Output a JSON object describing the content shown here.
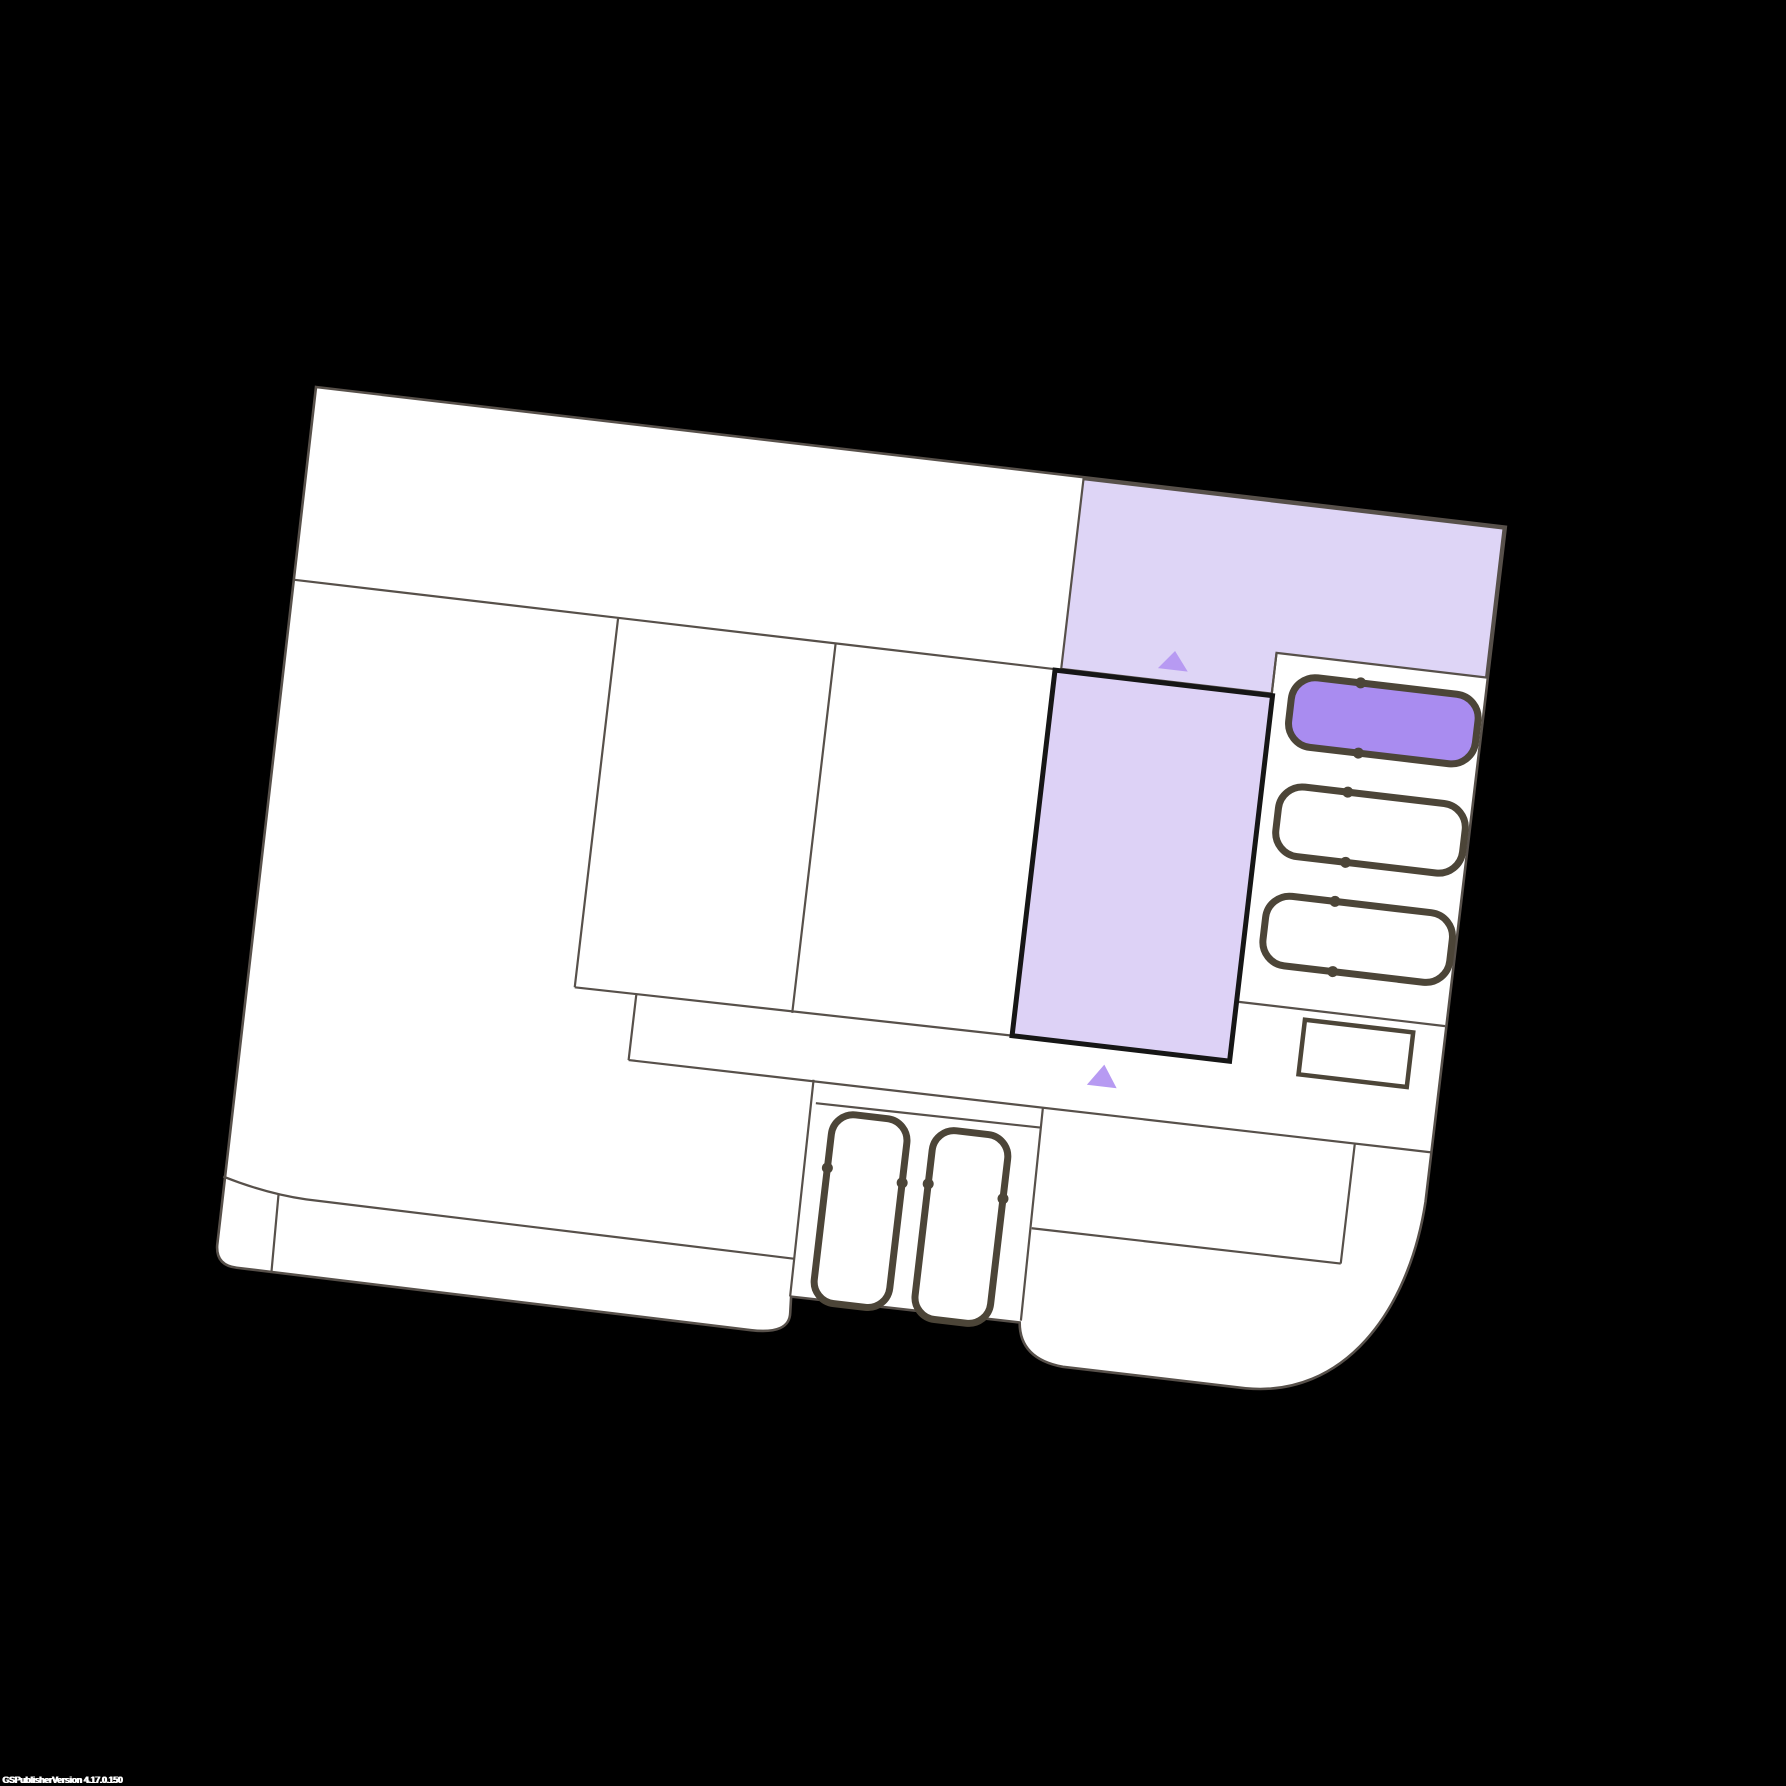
{
  "watermark": {
    "text": "GSPublisherVersion 4.17.0.150"
  },
  "palette": {
    "background": "#000000",
    "plan_fill": "#ffffff",
    "wall_line": "#57504a",
    "thick_line": "#4c4538",
    "selected_border": "#161616",
    "zone_fill": "#ded5f6",
    "selected_fill": "#ddd2f6",
    "occupied_vehicle_fill": "#a98cf0",
    "vehicle_fill": "#ffffff",
    "marker_fill": "#b79af2"
  },
  "plan": {
    "rotation_deg": 6.7,
    "parking": {
      "right_strip_spaces": 3,
      "right_strip_occupied": 1,
      "bottom_bay_vehicles": 2
    },
    "markers": 2
  }
}
